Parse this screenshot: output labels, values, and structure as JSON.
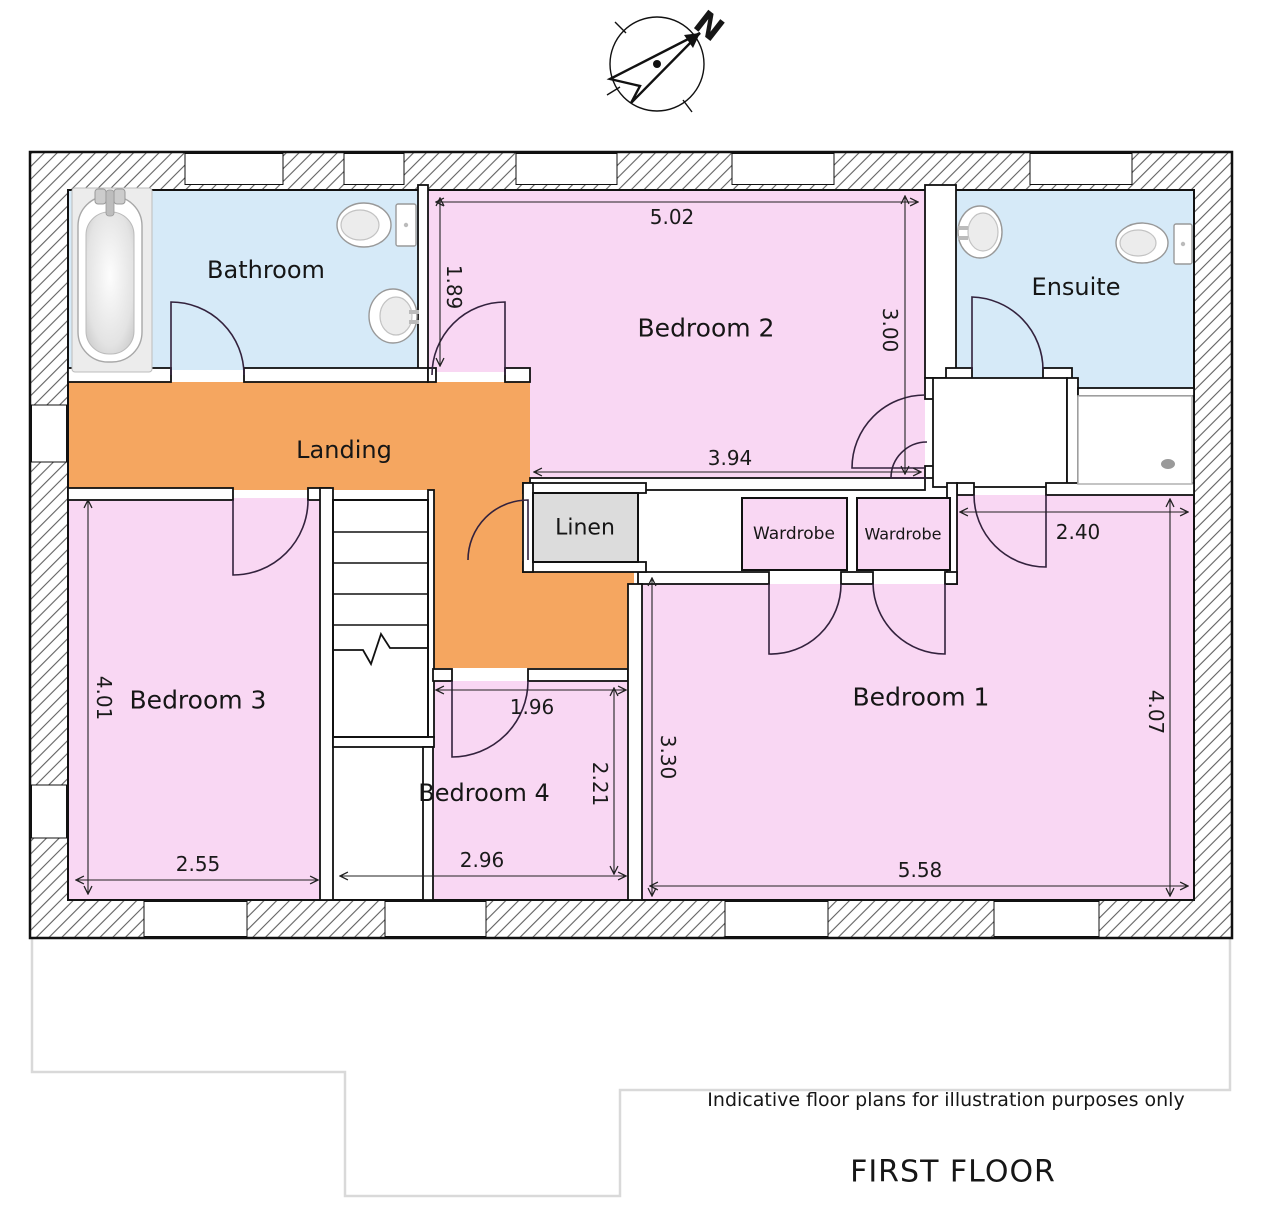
{
  "plan": {
    "title": "FIRST FLOOR",
    "disclaimer": "Indicative floor plans for illustration purposes only",
    "north_label": "N"
  },
  "rooms": {
    "bathroom": {
      "label": "Bathroom"
    },
    "bedroom2": {
      "label": "Bedroom 2"
    },
    "ensuite": {
      "label": "Ensuite"
    },
    "landing": {
      "label": "Landing"
    },
    "linen": {
      "label": "Linen"
    },
    "wardrobe_left": {
      "label": "Wardrobe"
    },
    "wardrobe_right": {
      "label": "Wardrobe"
    },
    "bedroom3": {
      "label": "Bedroom 3"
    },
    "bedroom4": {
      "label": "Bedroom 4"
    },
    "bedroom1": {
      "label": "Bedroom 1"
    }
  },
  "dimensions": {
    "bedroom2_top": "5.02",
    "bedroom2_left": "1.89",
    "bedroom2_right": "3.00",
    "bedroom2_bottom": "3.94",
    "bedroom1_top": "2.40",
    "bedroom1_left": "3.30",
    "bedroom1_right": "4.07",
    "bedroom1_bottom": "5.58",
    "bedroom3_left": "4.01",
    "bedroom3_bottom": "2.55",
    "bedroom4_top": "1.96",
    "bedroom4_right": "2.21",
    "bedroom4_bottom": "2.96"
  },
  "colors": {
    "bedroom_pink": "#f9d7f3",
    "landing_orange": "#f5a660",
    "bath_blue": "#d6eaf8",
    "linen_gray": "#dcdcdc",
    "ground_floor_outline": "#d9d9d9"
  }
}
